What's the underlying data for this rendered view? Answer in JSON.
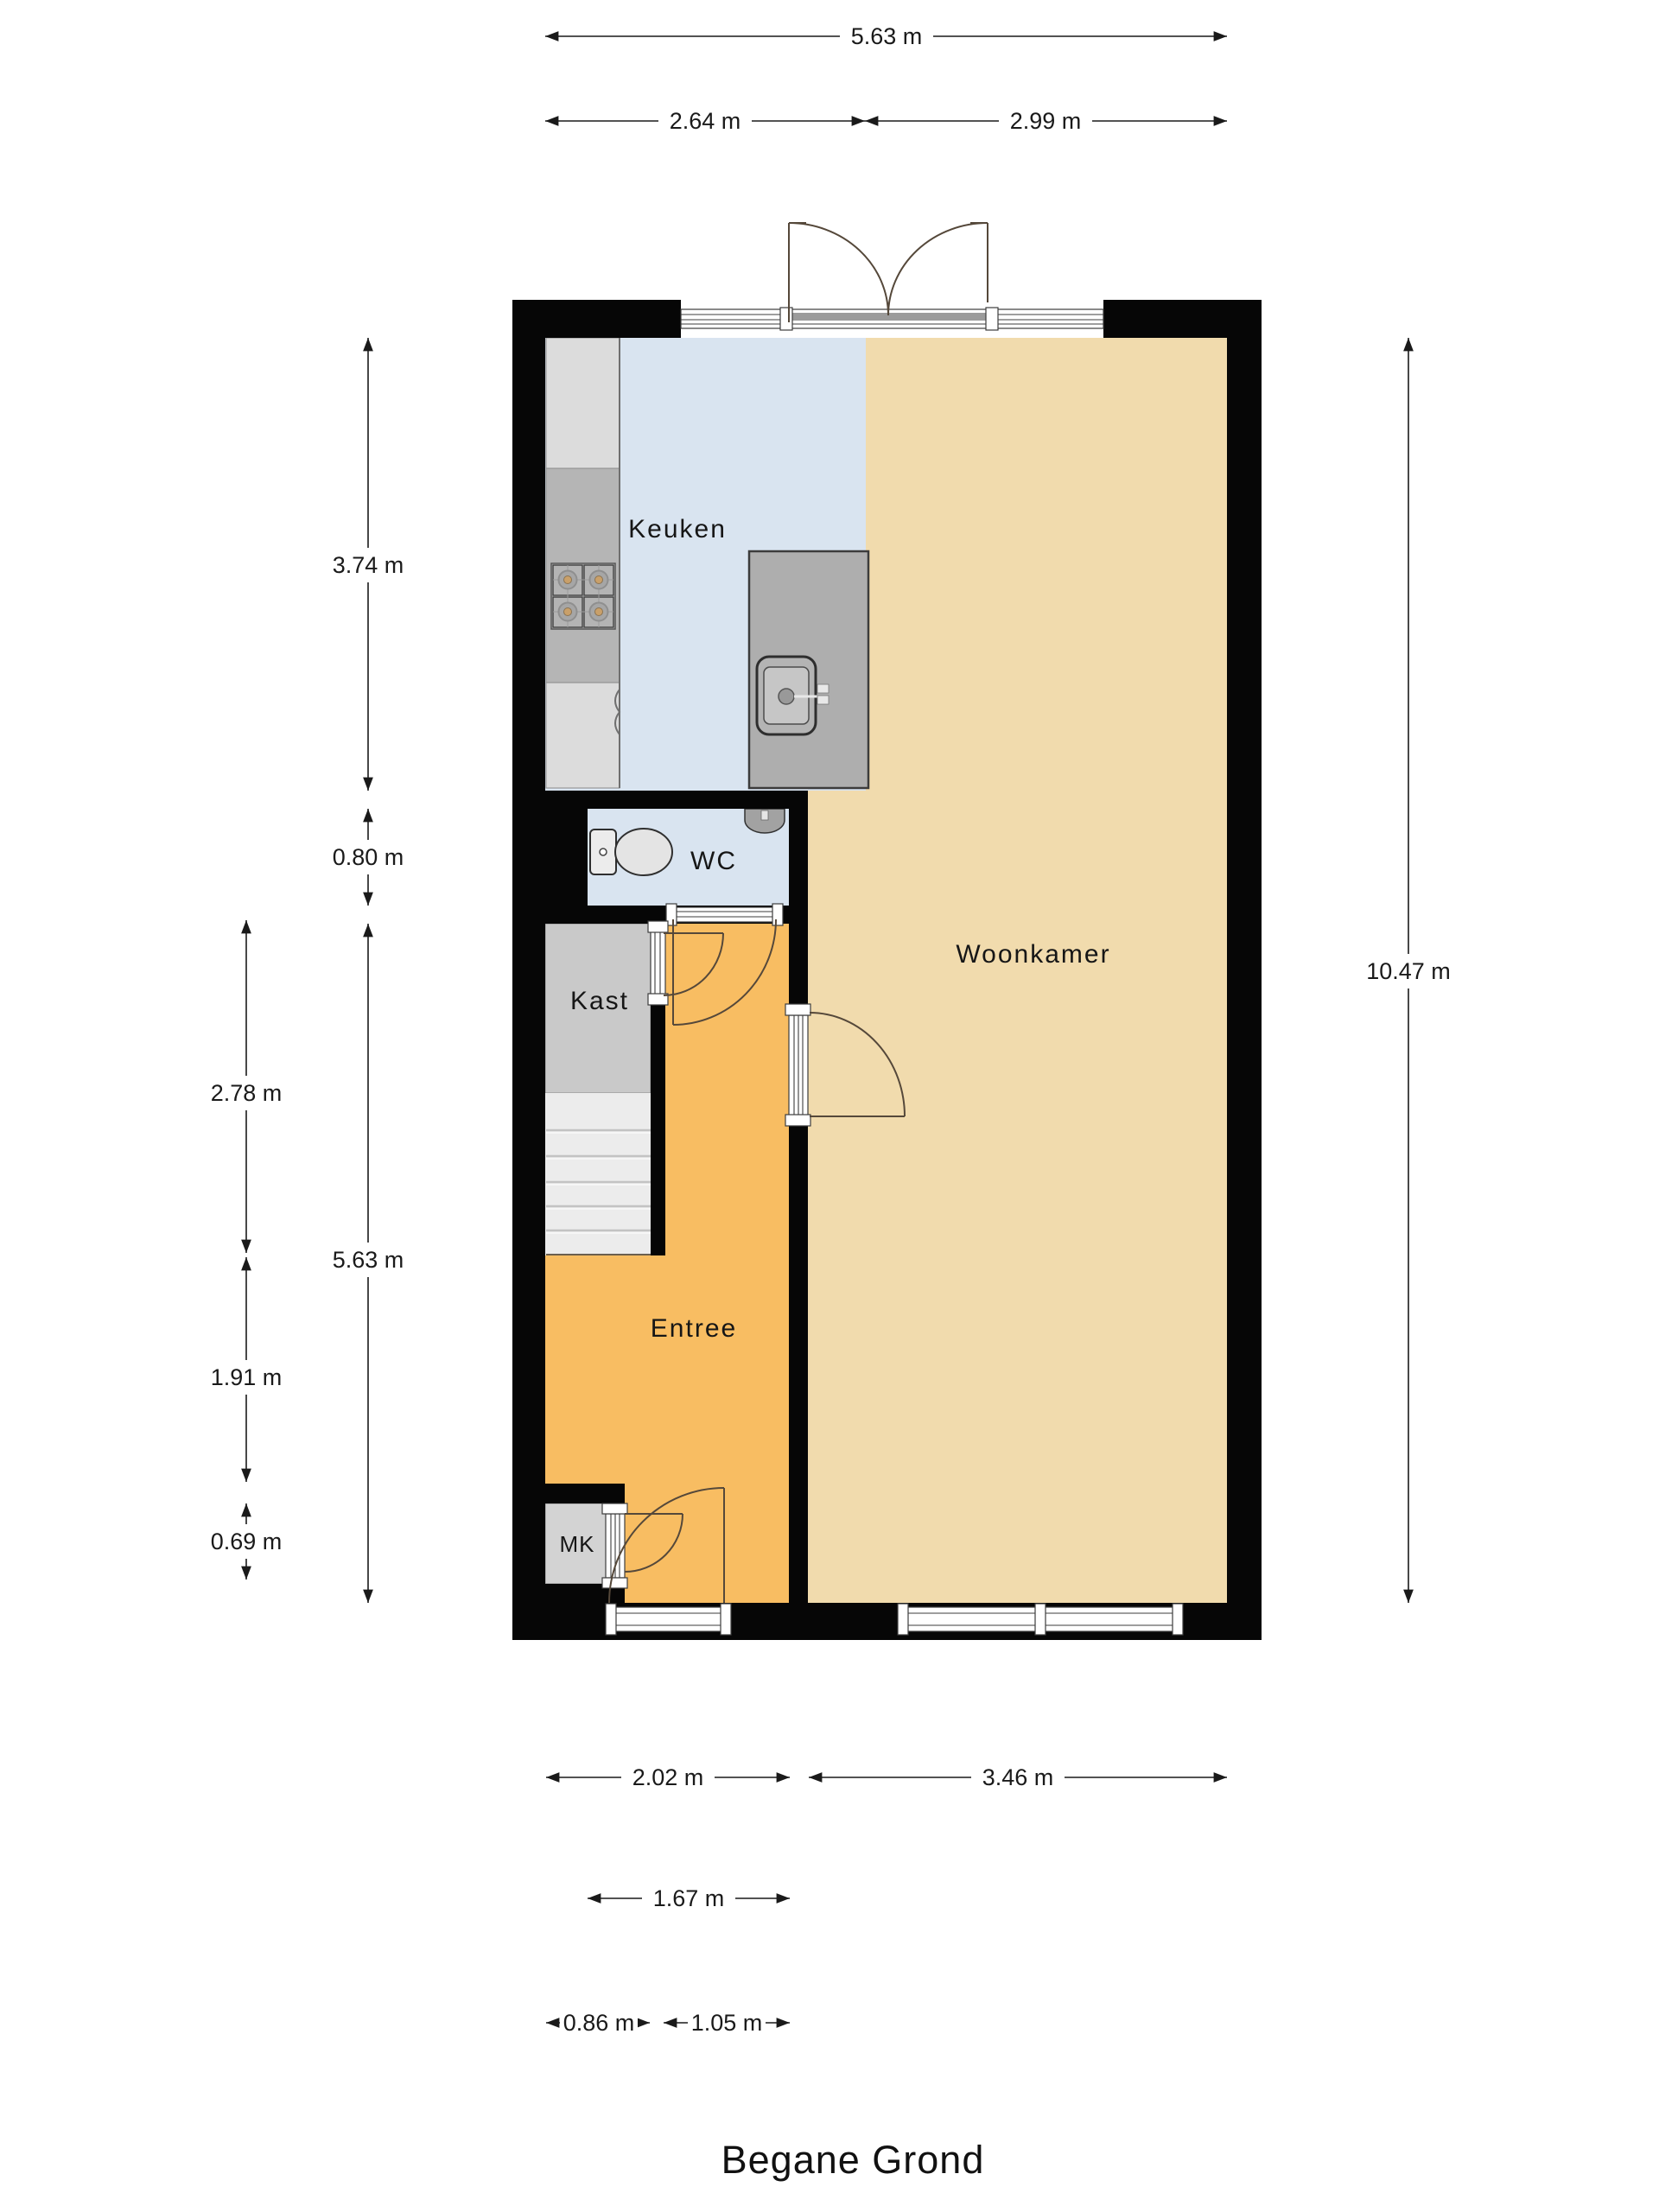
{
  "title": "Begane Grond",
  "plan": {
    "type": "floorplan-ground-floor",
    "wall_color": "#060606",
    "rooms": {
      "keuken": {
        "label": "Keuken",
        "floor_color": "#d9e4f0"
      },
      "woonkamer": {
        "label": "Woonkamer",
        "floor_color": "#f1dbad"
      },
      "wc": {
        "label": "WC",
        "floor_color": "#d9e4f0"
      },
      "kast": {
        "label": "Kast",
        "floor_color": "#c9c9c9"
      },
      "entree": {
        "label": "Entree",
        "floor_color": "#f8bd62"
      },
      "mk": {
        "label": "MK",
        "floor_color": "#d3d3d3"
      }
    },
    "fixtures": [
      "stove-icon",
      "kitchen-island",
      "sink-icon",
      "toilet-icon",
      "wc-sink-icon",
      "stairs"
    ]
  },
  "dims": {
    "top_total": "5.63 m",
    "top_left": "2.64 m",
    "top_right": "2.99 m",
    "left_inner_1": "3.74 m",
    "left_inner_2": "0.80 m",
    "left_inner_3": "5.63 m",
    "left_outer_1": "2.78 m",
    "left_outer_2": "1.91 m",
    "left_outer_3": "0.69 m",
    "right_total": "10.47 m",
    "bottom_1": "2.02 m",
    "bottom_2": "3.46 m",
    "bottom_3": "1.67 m",
    "bottom_4": "0.86 m",
    "bottom_5": "1.05 m"
  }
}
